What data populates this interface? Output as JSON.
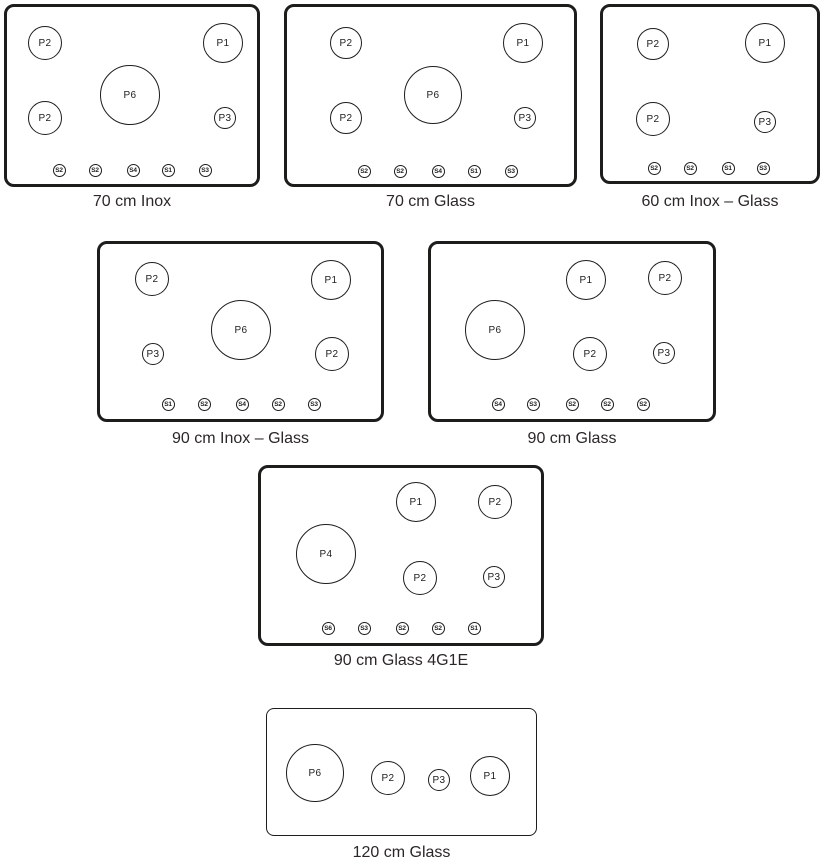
{
  "canvas": {
    "width": 825,
    "height": 866,
    "background": "#ffffff"
  },
  "style": {
    "stroke_color": "#1d1d1b",
    "caption_color": "#2b2728",
    "panel_fill": "#ffffff",
    "knob_radius": 6.5
  },
  "panels": [
    {
      "id": "70-cm-inox",
      "caption": "70 cm Inox",
      "box": {
        "x": 4,
        "y": 4,
        "w": 256,
        "h": 183,
        "stroke": 3,
        "radius": 10
      },
      "caption_top": 193,
      "burners": [
        {
          "label": "P2",
          "cx": 45,
          "cy": 43,
          "r": 17
        },
        {
          "label": "P1",
          "cx": 223,
          "cy": 43,
          "r": 20
        },
        {
          "label": "P6",
          "cx": 130,
          "cy": 95,
          "r": 30
        },
        {
          "label": "P2",
          "cx": 45,
          "cy": 118,
          "r": 17
        },
        {
          "label": "P3",
          "cx": 225,
          "cy": 118,
          "r": 11
        }
      ],
      "knobs": [
        {
          "label": "S2",
          "cx": 59,
          "cy": 170
        },
        {
          "label": "S2",
          "cx": 95,
          "cy": 170
        },
        {
          "label": "S4",
          "cx": 133,
          "cy": 170
        },
        {
          "label": "S1",
          "cx": 168,
          "cy": 170
        },
        {
          "label": "S3",
          "cx": 205,
          "cy": 170
        }
      ]
    },
    {
      "id": "70-cm-glass",
      "caption": "70 cm Glass",
      "box": {
        "x": 284,
        "y": 4,
        "w": 293,
        "h": 183,
        "stroke": 3,
        "radius": 10
      },
      "caption_top": 193,
      "burners": [
        {
          "label": "P2",
          "cx": 346,
          "cy": 43,
          "r": 16
        },
        {
          "label": "P1",
          "cx": 523,
          "cy": 43,
          "r": 20
        },
        {
          "label": "P6",
          "cx": 433,
          "cy": 95,
          "r": 29
        },
        {
          "label": "P2",
          "cx": 346,
          "cy": 118,
          "r": 16
        },
        {
          "label": "P3",
          "cx": 525,
          "cy": 118,
          "r": 11
        }
      ],
      "knobs": [
        {
          "label": "S2",
          "cx": 364,
          "cy": 171
        },
        {
          "label": "S2",
          "cx": 400,
          "cy": 171
        },
        {
          "label": "S4",
          "cx": 438,
          "cy": 171
        },
        {
          "label": "S1",
          "cx": 474,
          "cy": 171
        },
        {
          "label": "S3",
          "cx": 511,
          "cy": 171
        }
      ]
    },
    {
      "id": "60-cm-inox-glass",
      "caption": "60 cm Inox – Glass",
      "box": {
        "x": 600,
        "y": 4,
        "w": 220,
        "h": 180,
        "stroke": 3,
        "radius": 10
      },
      "caption_top": 193,
      "burners": [
        {
          "label": "P2",
          "cx": 653,
          "cy": 44,
          "r": 16
        },
        {
          "label": "P1",
          "cx": 765,
          "cy": 43,
          "r": 20
        },
        {
          "label": "P2",
          "cx": 653,
          "cy": 119,
          "r": 17
        },
        {
          "label": "P3",
          "cx": 765,
          "cy": 122,
          "r": 11
        }
      ],
      "knobs": [
        {
          "label": "S2",
          "cx": 654,
          "cy": 168
        },
        {
          "label": "S2",
          "cx": 690,
          "cy": 168
        },
        {
          "label": "S1",
          "cx": 728,
          "cy": 168
        },
        {
          "label": "S3",
          "cx": 763,
          "cy": 168
        }
      ]
    },
    {
      "id": "90-cm-inox-glass",
      "caption": "90 cm Inox – Glass",
      "box": {
        "x": 97,
        "y": 241,
        "w": 287,
        "h": 181,
        "stroke": 3,
        "radius": 10
      },
      "caption_top": 430,
      "burners": [
        {
          "label": "P2",
          "cx": 152,
          "cy": 279,
          "r": 17
        },
        {
          "label": "P1",
          "cx": 331,
          "cy": 280,
          "r": 20
        },
        {
          "label": "P6",
          "cx": 241,
          "cy": 330,
          "r": 30
        },
        {
          "label": "P3",
          "cx": 153,
          "cy": 354,
          "r": 11
        },
        {
          "label": "P2",
          "cx": 332,
          "cy": 354,
          "r": 17
        }
      ],
      "knobs": [
        {
          "label": "S1",
          "cx": 168,
          "cy": 404
        },
        {
          "label": "S2",
          "cx": 204,
          "cy": 404
        },
        {
          "label": "S4",
          "cx": 242,
          "cy": 404
        },
        {
          "label": "S2",
          "cx": 278,
          "cy": 404
        },
        {
          "label": "S3",
          "cx": 314,
          "cy": 404
        }
      ]
    },
    {
      "id": "90-cm-glass",
      "caption": "90 cm Glass",
      "box": {
        "x": 428,
        "y": 241,
        "w": 288,
        "h": 181,
        "stroke": 3,
        "radius": 10
      },
      "caption_top": 430,
      "burners": [
        {
          "label": "P1",
          "cx": 586,
          "cy": 280,
          "r": 20
        },
        {
          "label": "P2",
          "cx": 665,
          "cy": 278,
          "r": 17
        },
        {
          "label": "P6",
          "cx": 495,
          "cy": 330,
          "r": 30
        },
        {
          "label": "P2",
          "cx": 590,
          "cy": 354,
          "r": 17
        },
        {
          "label": "P3",
          "cx": 664,
          "cy": 353,
          "r": 11
        }
      ],
      "knobs": [
        {
          "label": "S4",
          "cx": 498,
          "cy": 404
        },
        {
          "label": "S3",
          "cx": 533,
          "cy": 404
        },
        {
          "label": "S2",
          "cx": 572,
          "cy": 404
        },
        {
          "label": "S2",
          "cx": 607,
          "cy": 404
        },
        {
          "label": "S2",
          "cx": 643,
          "cy": 404
        }
      ]
    },
    {
      "id": "90-cm-glass-4g1e",
      "caption": "90 cm Glass 4G1E",
      "box": {
        "x": 258,
        "y": 465,
        "w": 286,
        "h": 181,
        "stroke": 3,
        "radius": 10
      },
      "caption_top": 652,
      "burners": [
        {
          "label": "P1",
          "cx": 416,
          "cy": 502,
          "r": 20
        },
        {
          "label": "P2",
          "cx": 495,
          "cy": 502,
          "r": 17
        },
        {
          "label": "P4",
          "cx": 326,
          "cy": 554,
          "r": 30
        },
        {
          "label": "P2",
          "cx": 420,
          "cy": 578,
          "r": 17
        },
        {
          "label": "P3",
          "cx": 494,
          "cy": 577,
          "r": 11
        }
      ],
      "knobs": [
        {
          "label": "S6",
          "cx": 328,
          "cy": 628
        },
        {
          "label": "S3",
          "cx": 364,
          "cy": 628
        },
        {
          "label": "S2",
          "cx": 402,
          "cy": 628
        },
        {
          "label": "S2",
          "cx": 438,
          "cy": 628
        },
        {
          "label": "S1",
          "cx": 474,
          "cy": 628
        }
      ]
    },
    {
      "id": "120-cm-glass",
      "caption": "120 cm Glass",
      "box": {
        "x": 266,
        "y": 708,
        "w": 271,
        "h": 128,
        "stroke": 1.2,
        "radius": 8
      },
      "caption_top": 844,
      "burners": [
        {
          "label": "P6",
          "cx": 315,
          "cy": 773,
          "r": 29
        },
        {
          "label": "P2",
          "cx": 388,
          "cy": 778,
          "r": 17
        },
        {
          "label": "P3",
          "cx": 439,
          "cy": 780,
          "r": 11
        },
        {
          "label": "P1",
          "cx": 490,
          "cy": 776,
          "r": 20
        }
      ],
      "knobs": []
    }
  ]
}
